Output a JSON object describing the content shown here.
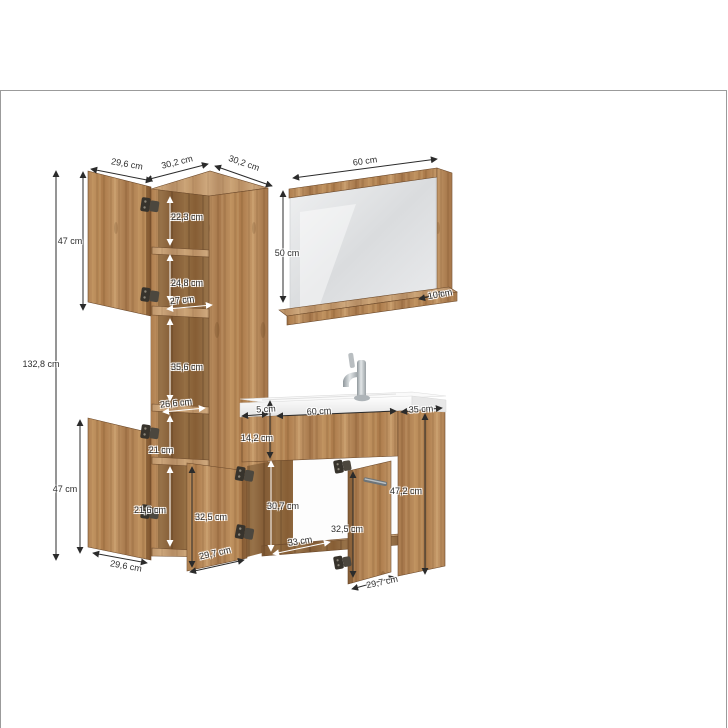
{
  "palette": {
    "wood": "#b38354",
    "wood_dark": "#8a5f3a",
    "wood_edge": "#6d4a2b",
    "dimension_line_dark": "#2b2b2b",
    "dimension_line_light": "#ffffff",
    "label_text": "#2e2e2e",
    "mirror_glass": "#e3e5e6",
    "ceramic": "#f4f4f4",
    "metal": "#a9b0b4",
    "frame_border": "#9b9b9b",
    "background": "#ffffff"
  },
  "pieces": {
    "tall_cabinet": {
      "name": "tall cabinet",
      "dimensions": [
        {
          "value": "29,6 cm",
          "x": 127,
          "y": 164,
          "rot": 10,
          "style": "dark",
          "line": {
            "x1": 91,
            "y1": 169,
            "x2": 152,
            "y2": 181
          }
        },
        {
          "value": "30,2 cm",
          "x": 177,
          "y": 162,
          "rot": -14,
          "style": "dark",
          "line": {
            "x1": 146,
            "y1": 180,
            "x2": 208,
            "y2": 164
          }
        },
        {
          "value": "30,2 cm",
          "x": 244,
          "y": 163,
          "rot": 19,
          "style": "dark",
          "line": {
            "x1": 215,
            "y1": 166,
            "x2": 272,
            "y2": 186
          }
        },
        {
          "value": "47 cm",
          "x": 70,
          "y": 241,
          "rot": 0,
          "style": "dark",
          "line": {
            "x1": 83,
            "y1": 172,
            "x2": 83,
            "y2": 310
          }
        },
        {
          "value": "22,3 cm",
          "x": 187,
          "y": 217,
          "rot": 0,
          "style": "light",
          "line": {
            "x1": 170,
            "y1": 197,
            "x2": 170,
            "y2": 245
          }
        },
        {
          "value": "24,8 cm",
          "x": 187,
          "y": 283,
          "rot": 0,
          "style": "light",
          "line": {
            "x1": 170,
            "y1": 255,
            "x2": 170,
            "y2": 302
          }
        },
        {
          "value": "27 cm",
          "x": 182,
          "y": 300,
          "rot": -6,
          "style": "light",
          "line": {
            "x1": 167,
            "y1": 309,
            "x2": 212,
            "y2": 305
          }
        },
        {
          "value": "35,6 cm",
          "x": 187,
          "y": 367,
          "rot": 0,
          "style": "light",
          "line": {
            "x1": 170,
            "y1": 319,
            "x2": 170,
            "y2": 401
          }
        },
        {
          "value": "26,6 cm",
          "x": 176,
          "y": 403,
          "rot": -6,
          "style": "light",
          "line": {
            "x1": 163,
            "y1": 412,
            "x2": 205,
            "y2": 408
          }
        },
        {
          "value": "132,8 cm",
          "x": 41,
          "y": 364,
          "rot": 0,
          "style": "dark",
          "line": {
            "x1": 56,
            "y1": 171,
            "x2": 56,
            "y2": 560
          }
        },
        {
          "value": "21 cm",
          "x": 161,
          "y": 450,
          "rot": 0,
          "style": "light",
          "line": {
            "x1": 170,
            "y1": 416,
            "x2": 170,
            "y2": 455
          }
        },
        {
          "value": "47 cm",
          "x": 65,
          "y": 489,
          "rot": 0,
          "style": "dark",
          "line": {
            "x1": 80,
            "y1": 420,
            "x2": 80,
            "y2": 553
          }
        },
        {
          "value": "21,6 cm",
          "x": 150,
          "y": 510,
          "rot": 0,
          "style": "light",
          "line": {
            "x1": 170,
            "y1": 467,
            "x2": 170,
            "y2": 546
          }
        },
        {
          "value": "29,6 cm",
          "x": 126,
          "y": 566,
          "rot": 10,
          "style": "dark",
          "line": {
            "x1": 93,
            "y1": 553,
            "x2": 147,
            "y2": 563
          }
        }
      ]
    },
    "mirror": {
      "name": "mirror with shelf",
      "dimensions": [
        {
          "value": "60 cm",
          "x": 365,
          "y": 161,
          "rot": -8,
          "style": "dark",
          "line": {
            "x1": 293,
            "y1": 178,
            "x2": 437,
            "y2": 159
          }
        },
        {
          "value": "50 cm",
          "x": 287,
          "y": 253,
          "rot": 0,
          "style": "dark",
          "line": {
            "x1": 283,
            "y1": 191,
            "x2": 283,
            "y2": 302
          }
        },
        {
          "value": "10 cm",
          "x": 440,
          "y": 294,
          "rot": -10,
          "style": "dark",
          "line": {
            "x1": 419,
            "y1": 299,
            "x2": 445,
            "y2": 293
          }
        }
      ]
    },
    "washbasin_cabinet": {
      "name": "washbasin cabinet",
      "dimensions": [
        {
          "value": "5 cm",
          "x": 266,
          "y": 409,
          "rot": -3,
          "style": "dark",
          "line": {
            "x1": 242,
            "y1": 416,
            "x2": 268,
            "y2": 414
          }
        },
        {
          "value": "60 cm",
          "x": 319,
          "y": 411,
          "rot": -3,
          "style": "dark",
          "line": {
            "x1": 277,
            "y1": 416,
            "x2": 396,
            "y2": 411
          }
        },
        {
          "value": "35 cm",
          "x": 421,
          "y": 409,
          "rot": -3,
          "style": "dark",
          "line": {
            "x1": 401,
            "y1": 412,
            "x2": 442,
            "y2": 408
          }
        },
        {
          "value": "14,2 cm",
          "x": 257,
          "y": 438,
          "rot": 0,
          "style": "dark",
          "line": {
            "x1": 270,
            "y1": 401,
            "x2": 270,
            "y2": 458
          }
        },
        {
          "value": "30,7 cm",
          "x": 283,
          "y": 506,
          "rot": 0,
          "style": "light",
          "line": {
            "x1": 271,
            "y1": 461,
            "x2": 271,
            "y2": 551
          }
        },
        {
          "value": "32,5 cm",
          "x": 211,
          "y": 517,
          "rot": 0,
          "style": "dark",
          "line": {
            "x1": 192,
            "y1": 467,
            "x2": 192,
            "y2": 567
          }
        },
        {
          "value": "29,7 cm",
          "x": 215,
          "y": 553,
          "rot": -13,
          "style": "dark",
          "line": {
            "x1": 190,
            "y1": 572,
            "x2": 244,
            "y2": 560
          }
        },
        {
          "value": "33 cm",
          "x": 300,
          "y": 541,
          "rot": -9,
          "style": "light",
          "line": {
            "x1": 273,
            "y1": 554,
            "x2": 330,
            "y2": 542
          }
        },
        {
          "value": "32,5 cm",
          "x": 347,
          "y": 529,
          "rot": 0,
          "style": "dark",
          "line": {
            "x1": 353,
            "y1": 472,
            "x2": 353,
            "y2": 577
          }
        },
        {
          "value": "47,2 cm",
          "x": 406,
          "y": 491,
          "rot": 0,
          "style": "dark",
          "line": {
            "x1": 425,
            "y1": 414,
            "x2": 425,
            "y2": 574
          }
        },
        {
          "value": "29,7 cm",
          "x": 382,
          "y": 582,
          "rot": -12,
          "style": "dark",
          "line": {
            "x1": 352,
            "y1": 589,
            "x2": 395,
            "y2": 577
          }
        }
      ]
    }
  }
}
